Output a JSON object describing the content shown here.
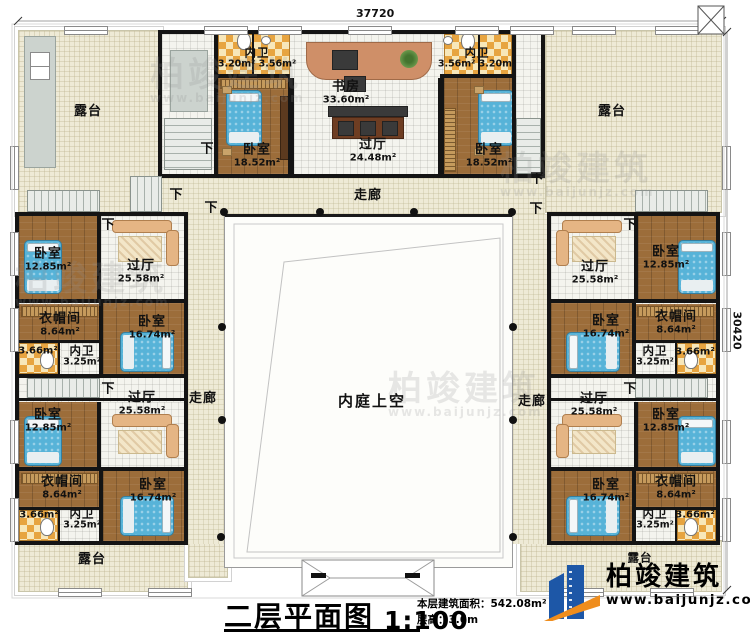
{
  "title_block": {
    "title": "二层平面图",
    "scale": "1:100",
    "area_text": "本层建筑面积：542.08m²",
    "height_text": "层高：3.6m"
  },
  "dimensions": {
    "top": "37720",
    "right": "30420"
  },
  "brand": {
    "name": "柏竣建筑",
    "url": "www.baijunjz.com"
  },
  "labels": {
    "down": "下"
  },
  "room_labels": [
    {
      "id": "terrace-top-left",
      "name": "露台",
      "area": "",
      "x": 88,
      "y": 112
    },
    {
      "id": "terrace-top-right",
      "name": "露台",
      "area": "",
      "x": 612,
      "y": 112
    },
    {
      "id": "terrace-bottom-left",
      "name": "露台",
      "area": "",
      "x": 92,
      "y": 560
    },
    {
      "id": "terrace-bottom-right",
      "name": "露台",
      "area": "",
      "x": 640,
      "y": 558,
      "size": "sm"
    },
    {
      "id": "corridor-top",
      "name": "走廊",
      "area": "",
      "x": 368,
      "y": 196
    },
    {
      "id": "corridor-left",
      "name": "走廊",
      "area": "",
      "x": 203,
      "y": 399
    },
    {
      "id": "corridor-right",
      "name": "走廊",
      "area": "",
      "x": 532,
      "y": 402
    },
    {
      "id": "courtyard",
      "name": "内庭上空",
      "area": "",
      "x": 372,
      "y": 401,
      "size": "lg"
    },
    {
      "id": "study",
      "name": "书房",
      "area": "33.60m²",
      "x": 346,
      "y": 93
    },
    {
      "id": "hall-top",
      "name": "过厅",
      "area": "24.48m²",
      "x": 373,
      "y": 151
    },
    {
      "id": "bath-top-left",
      "name": "内卫",
      "area": "3.20m² 3.56m²",
      "x": 257,
      "y": 58,
      "size": "sm"
    },
    {
      "id": "bath-top-right",
      "name": "内卫",
      "area": "3.56m² 3.20m²",
      "x": 477,
      "y": 58,
      "size": "sm"
    },
    {
      "id": "bedroom-top-left",
      "name": "卧室",
      "area": "18.52m²",
      "x": 257,
      "y": 156
    },
    {
      "id": "bedroom-top-right",
      "name": "卧室",
      "area": "18.52m²",
      "x": 489,
      "y": 156
    },
    {
      "id": "lw-upper-bedroom1",
      "name": "卧室",
      "area": "12.85m²",
      "x": 48,
      "y": 260
    },
    {
      "id": "lw-upper-hall",
      "name": "过厅",
      "area": "25.58m²",
      "x": 141,
      "y": 272
    },
    {
      "id": "lw-upper-closet",
      "name": "衣帽间",
      "area": "8.64m²",
      "x": 60,
      "y": 325
    },
    {
      "id": "lw-upper-bath2",
      "name": "",
      "area": "3.66m²",
      "x": 38,
      "y": 351
    },
    {
      "id": "lw-upper-bath",
      "name": "内卫",
      "area": "3.25m²",
      "x": 82,
      "y": 356,
      "size": "sm"
    },
    {
      "id": "lw-upper-bedroom2",
      "name": "卧室",
      "area": "16.74m²",
      "x": 152,
      "y": 328
    },
    {
      "id": "lw-lower-bedroom1",
      "name": "卧室",
      "area": "12.85m²",
      "x": 48,
      "y": 421
    },
    {
      "id": "lw-lower-hall",
      "name": "过厅",
      "area": "25.58m²",
      "x": 142,
      "y": 404
    },
    {
      "id": "lw-lower-closet",
      "name": "衣帽间",
      "area": "8.64m²",
      "x": 62,
      "y": 488
    },
    {
      "id": "lw-lower-bath2",
      "name": "",
      "area": "3.66m²",
      "x": 39,
      "y": 515
    },
    {
      "id": "lw-lower-bath",
      "name": "内卫",
      "area": "3.25m²",
      "x": 82,
      "y": 519,
      "size": "sm"
    },
    {
      "id": "lw-lower-bedroom2",
      "name": "卧室",
      "area": "16.74m²",
      "x": 153,
      "y": 491
    },
    {
      "id": "rw-upper-bedroom1",
      "name": "卧室",
      "area": "12.85m²",
      "x": 666,
      "y": 258
    },
    {
      "id": "rw-upper-hall",
      "name": "过厅",
      "area": "25.58m²",
      "x": 595,
      "y": 273
    },
    {
      "id": "rw-upper-closet",
      "name": "衣帽间",
      "area": "8.64m²",
      "x": 676,
      "y": 323
    },
    {
      "id": "rw-upper-bath2",
      "name": "",
      "area": "3.66m²",
      "x": 695,
      "y": 352
    },
    {
      "id": "rw-upper-bath",
      "name": "内卫",
      "area": "3.25m²",
      "x": 655,
      "y": 356,
      "size": "sm"
    },
    {
      "id": "rw-upper-bedroom2",
      "name": "卧室",
      "area": "16.74m²",
      "x": 606,
      "y": 327
    },
    {
      "id": "rw-lower-bedroom1",
      "name": "卧室",
      "area": "12.85m²",
      "x": 666,
      "y": 421
    },
    {
      "id": "rw-lower-hall",
      "name": "过厅",
      "area": "25.58m²",
      "x": 594,
      "y": 405
    },
    {
      "id": "rw-lower-closet",
      "name": "衣帽间",
      "area": "8.64m²",
      "x": 676,
      "y": 488
    },
    {
      "id": "rw-lower-bath2",
      "name": "",
      "area": "3.66m²",
      "x": 695,
      "y": 515
    },
    {
      "id": "rw-lower-bath",
      "name": "内卫",
      "area": "3.25m²",
      "x": 655,
      "y": 519,
      "size": "sm"
    },
    {
      "id": "rw-lower-bedroom2",
      "name": "卧室",
      "area": "16.74m²",
      "x": 606,
      "y": 491
    }
  ],
  "down_labels": [
    {
      "x": 207,
      "y": 147
    },
    {
      "x": 176,
      "y": 193
    },
    {
      "x": 211,
      "y": 206
    },
    {
      "x": 108,
      "y": 223
    },
    {
      "x": 108,
      "y": 387
    },
    {
      "x": 537,
      "y": 177
    },
    {
      "x": 536,
      "y": 207
    },
    {
      "x": 630,
      "y": 223
    },
    {
      "x": 630,
      "y": 387
    }
  ]
}
